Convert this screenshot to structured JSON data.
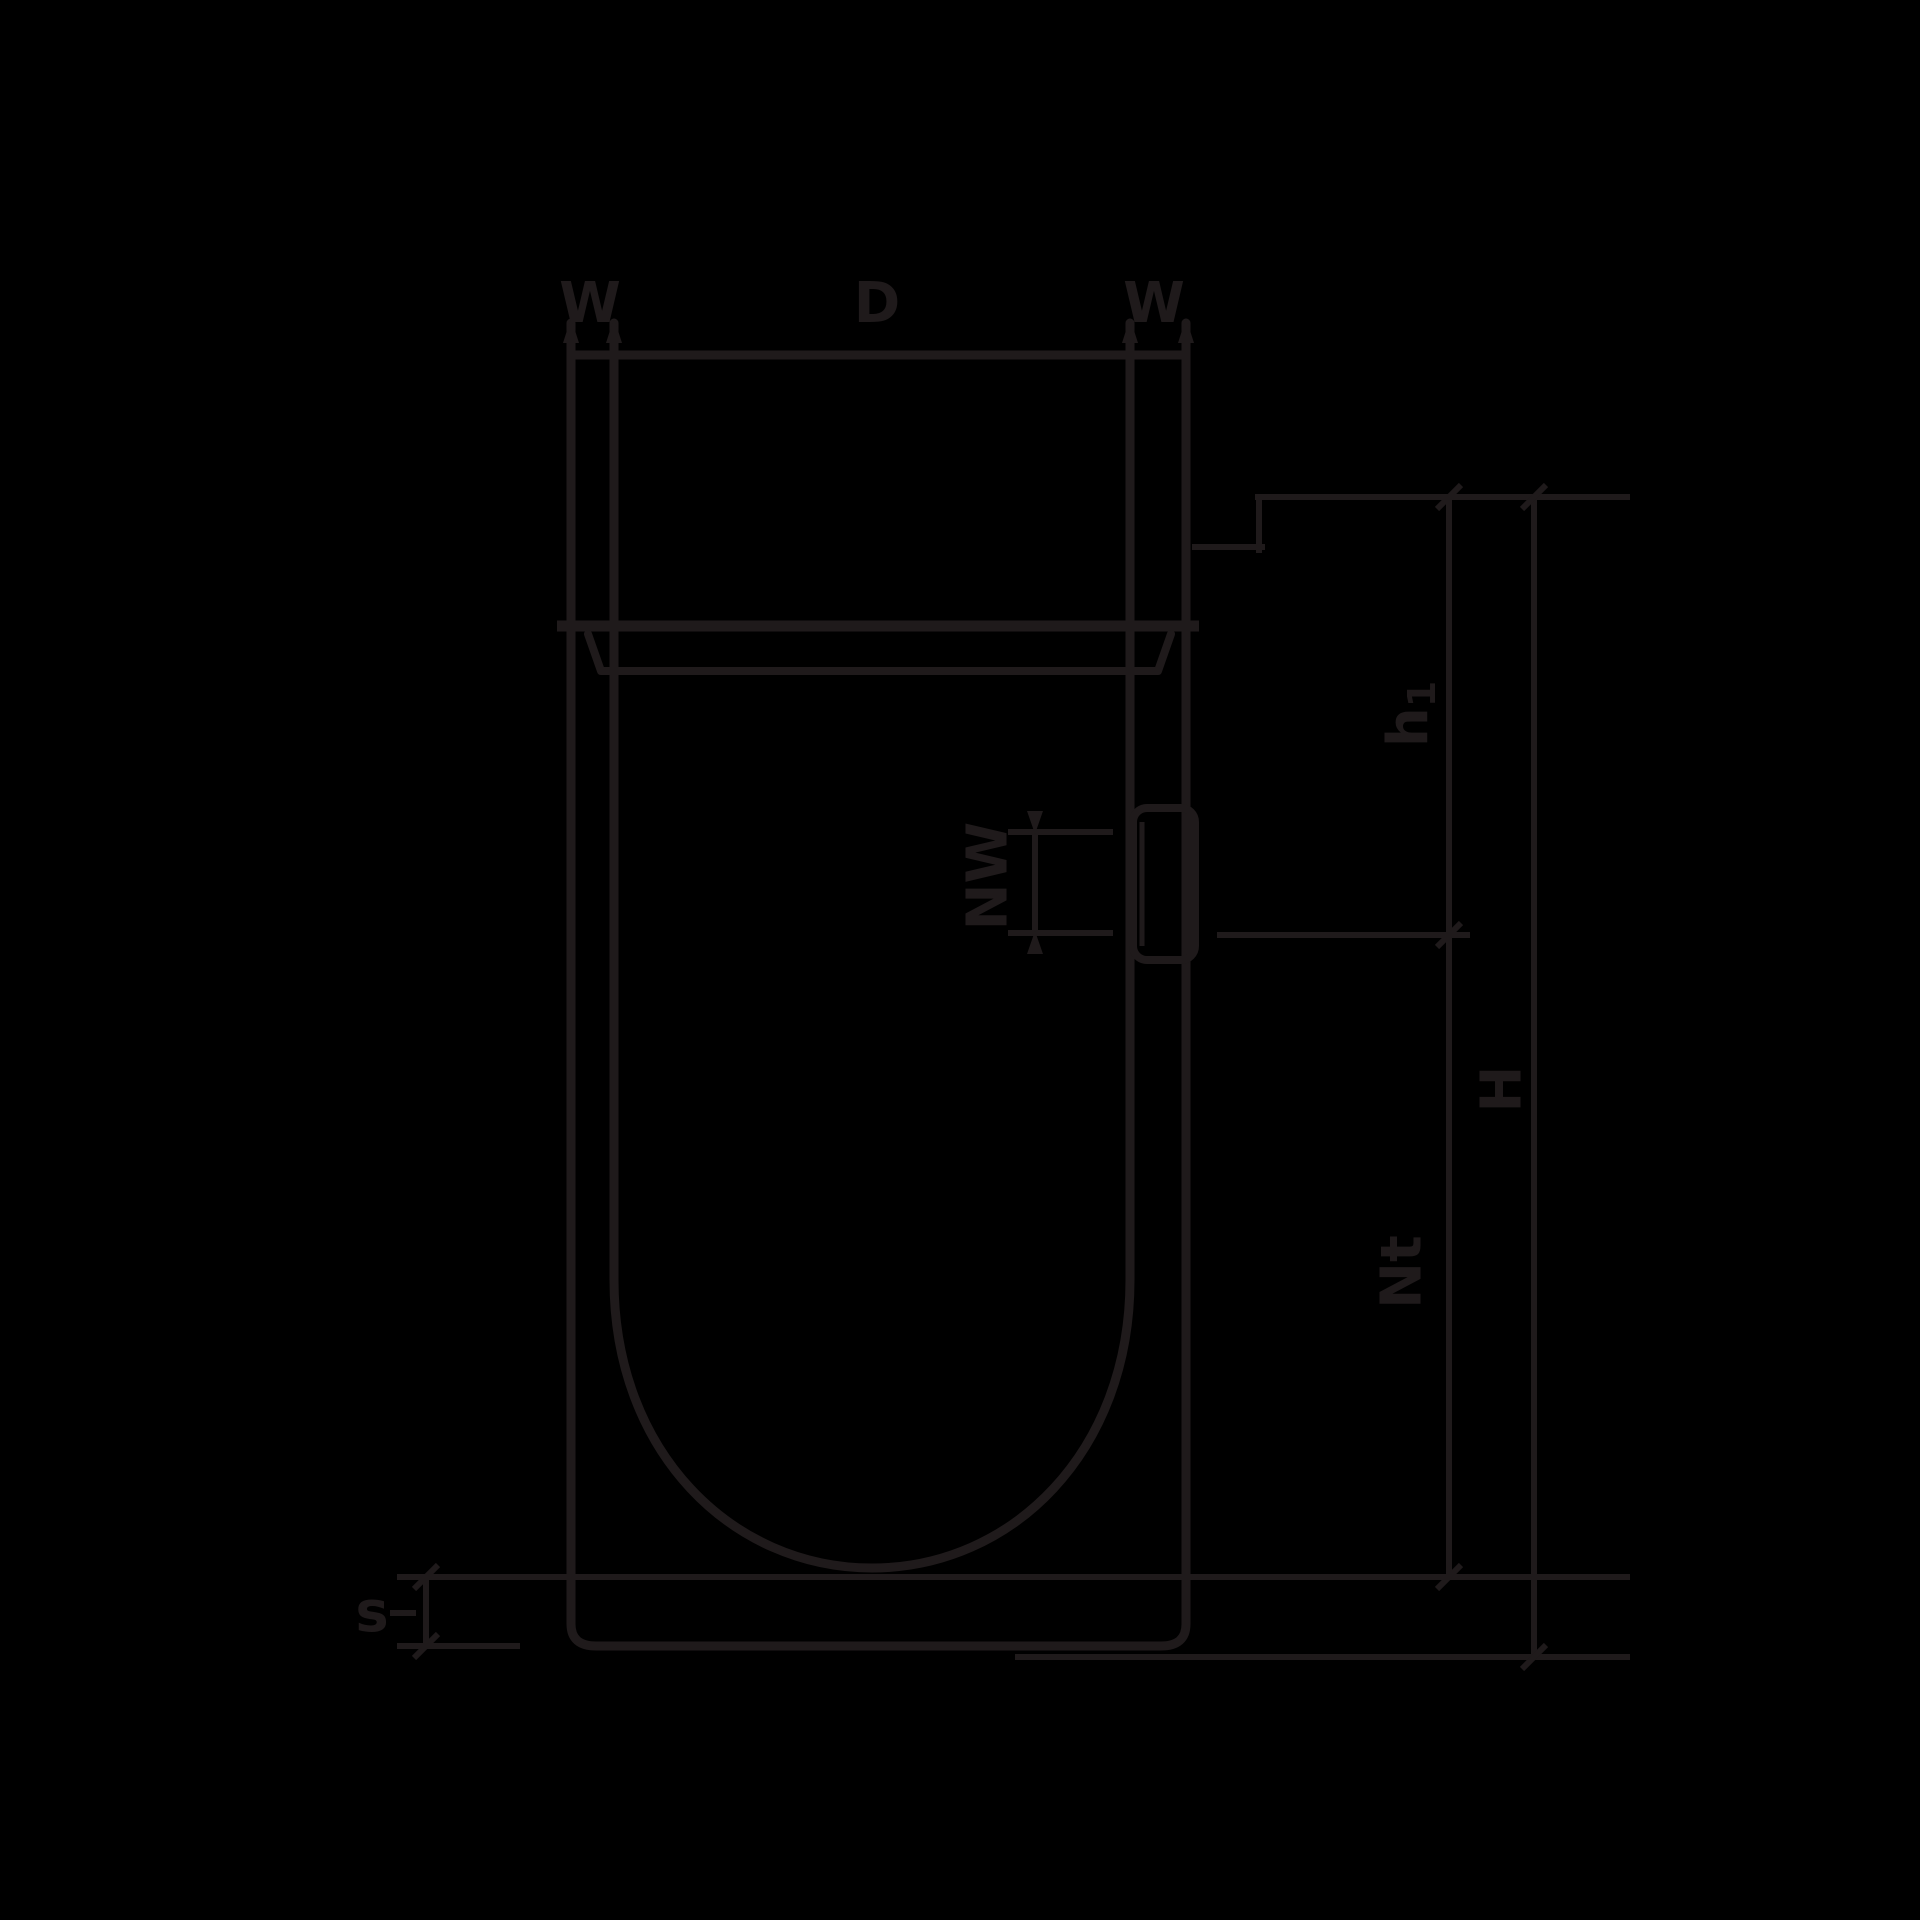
{
  "page": {
    "background": "#000000",
    "ink": "#1f1a1b"
  },
  "drawing": {
    "kind": "technical dimension drawing of a cylindrical vessel with round bottom, top flange and side hose port",
    "top_dimensions": {
      "wall_left": "W",
      "inner_diameter": "D",
      "wall_right": "W"
    },
    "right_dimensions": {
      "upper_height_base": "h",
      "upper_height_sub": "1",
      "total_height": "H",
      "usable_depth": "Nt"
    },
    "side_port": {
      "nominal_width": "NW"
    },
    "base": {
      "bottom_gap": "s"
    }
  }
}
